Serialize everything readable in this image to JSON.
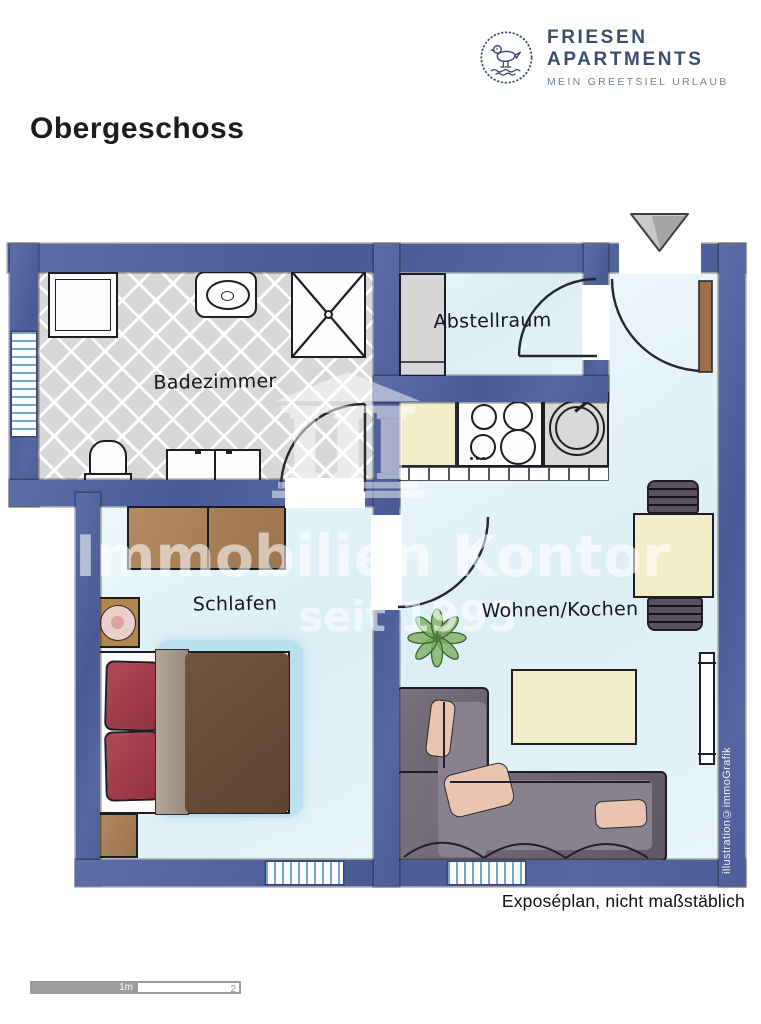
{
  "brand": {
    "name": "FRIESEN APARTMENTS",
    "tagline": "MEIN GREETSIEL URLAUB",
    "icon": "seagull-icon",
    "color": "#3c4e6d"
  },
  "page": {
    "title": "Obergeschoss"
  },
  "plan": {
    "rooms": [
      {
        "label": "Badezimmer"
      },
      {
        "label": "Abstellraum"
      },
      {
        "label": "Schlafen"
      },
      {
        "label": "Wohnen/Kochen"
      }
    ],
    "caption": "Exposéplan, nicht maßstäblich",
    "credit": "illustration©immoGrafik",
    "watermark": {
      "line1": "S Immobilien Kontor",
      "line2": "seit 1995"
    }
  },
  "scale_bar": {
    "first": "1m",
    "second": "2"
  },
  "colors": {
    "wall_blue": "#4f6097",
    "floor_blue": "#e6f3f8",
    "bath_tile": "#d8d8d8",
    "wood_brown": "#a9805b",
    "duvet_brown": "#6d4f3c",
    "pillow_red": "#a23a49",
    "sofa_gray": "#6e6573",
    "counter_cream": "#f4ecc7",
    "plant_green": "#7cb061",
    "brand_navy": "#3c4e6d"
  }
}
